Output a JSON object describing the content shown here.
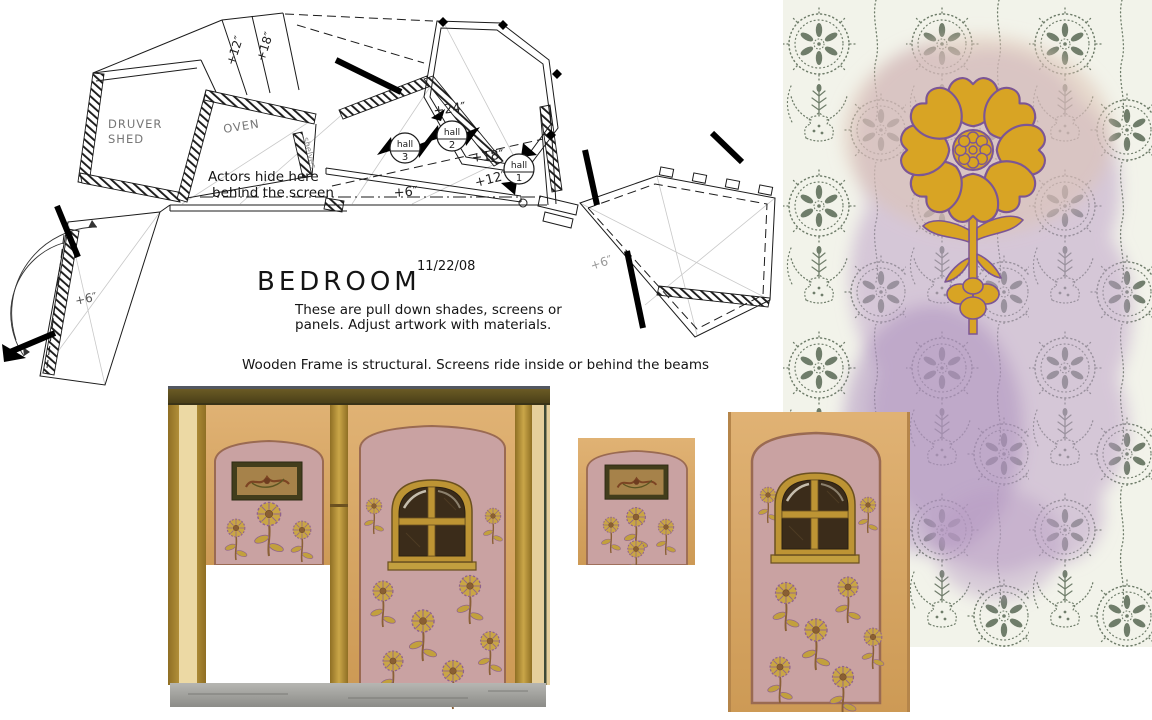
{
  "document": {
    "title": "BEDROOM",
    "date": "11/22/08",
    "note_line1": "These are pull down shades, screens or",
    "note_line2": "panels.  Adjust artwork with materials.",
    "note_line3": "Wooden Frame is structural.  Screens ride inside or behind the beams"
  },
  "plan": {
    "rooms": {
      "druver_line1": "DRUVER",
      "druver_line2": "SHED",
      "oven": "OVEN",
      "shelves": "shelves"
    },
    "annotation_line1": "Actors hide here",
    "annotation_line2": "behind the screen",
    "halls": [
      {
        "name": "hall",
        "number": "3"
      },
      {
        "name": "hall",
        "number": "2"
      },
      {
        "name": "hall",
        "number": "1"
      }
    ],
    "dimensions": {
      "corridor_left": "+12″",
      "corridor_right": "+18″",
      "top": "+24″",
      "mid": "+18″",
      "low": "+12″",
      "base": "+6″",
      "left_wing": "+6″",
      "right_wing": "+6″"
    }
  },
  "colors": {
    "ink": "#1b1b1b",
    "flower_gold": "#d8a424",
    "outline_purple": "#7c5694",
    "wash_lavender": "#bda2c8",
    "pattern_green": "#6f7d6a",
    "wall_tan": "#d9a967",
    "screen_pink": "#c9a2a2",
    "beam_gold": "#b8922f",
    "base_gray": "#9c9c98"
  }
}
